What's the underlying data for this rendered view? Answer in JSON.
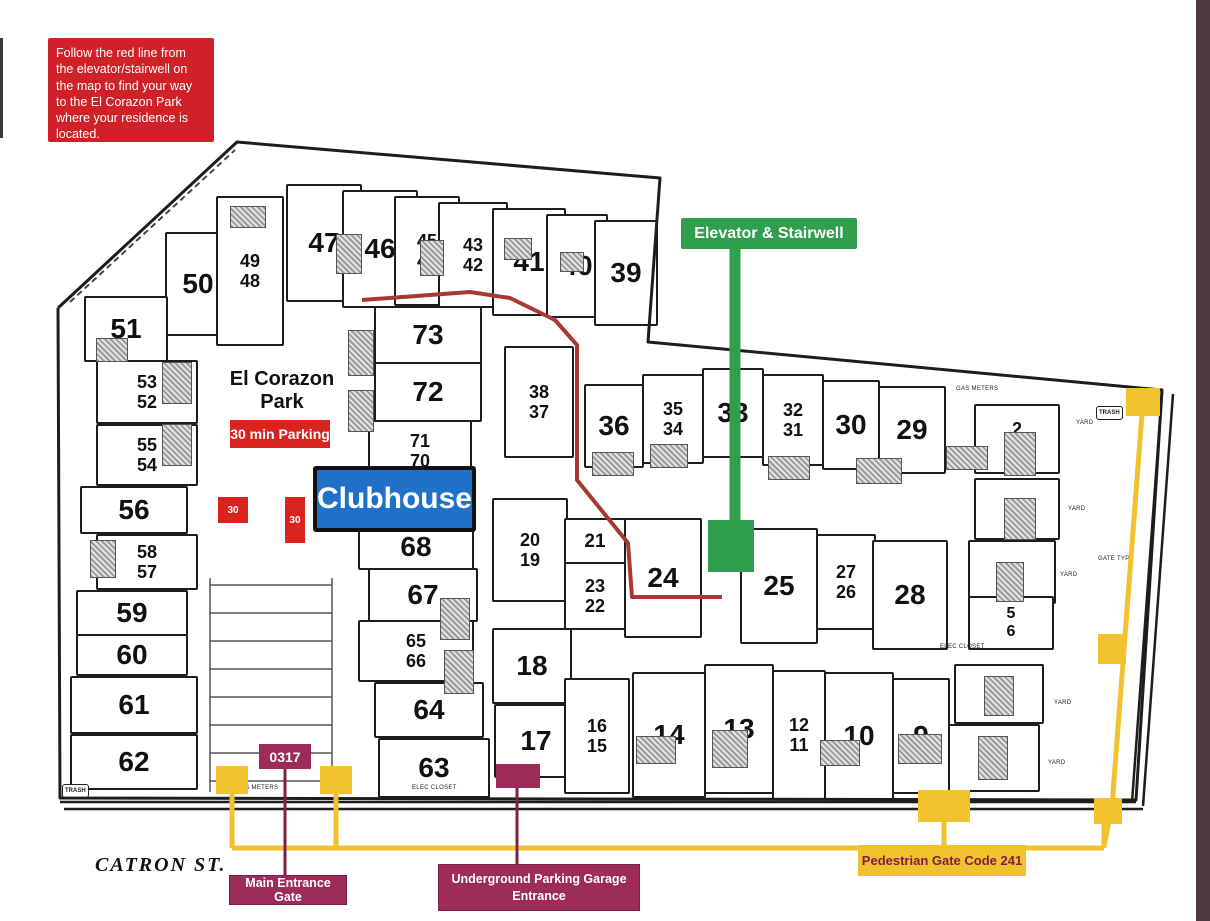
{
  "colors": {
    "red": "#cf2127",
    "maroon": "#9e2c58",
    "maroon_dark": "#7c2145",
    "yellow": "#f2c12e",
    "green": "#2f9e4d",
    "blue": "#1e71c6",
    "route_red": "#a83832",
    "ink": "#1d1d1d",
    "edge": "#4d3a41"
  },
  "annotations": {
    "instruction": "Follow the red line from the elevator/stairwell on the map to find your way to the El Corazon Park where your residence is located.",
    "elevator": "Elevator & Stairwell",
    "clubhouse": "Clubhouse",
    "park": "El Corazon\nPark",
    "parking": "30 min Parking",
    "stall": "30",
    "gate_code": "0317",
    "main_gate": "Main Entrance Gate",
    "garage": "Underground Parking Garage Entrance",
    "pedestrian": "Pedestrian Gate Code 241",
    "street": "CATRON ST."
  },
  "map": {
    "units": [
      {
        "label": "50",
        "x": 165,
        "y": 232,
        "w": 62,
        "h": 100,
        "fs": 28
      },
      {
        "label": "49\n48",
        "x": 216,
        "y": 196,
        "w": 64,
        "h": 146,
        "fs": 18
      },
      {
        "label": "47",
        "x": 286,
        "y": 184,
        "w": 72,
        "h": 114,
        "fs": 28
      },
      {
        "label": "46",
        "x": 342,
        "y": 190,
        "w": 72,
        "h": 114,
        "fs": 28
      },
      {
        "label": "45\n44",
        "x": 394,
        "y": 196,
        "w": 62,
        "h": 106,
        "fs": 18
      },
      {
        "label": "43\n42",
        "x": 438,
        "y": 202,
        "w": 66,
        "h": 102,
        "fs": 18
      },
      {
        "label": "41",
        "x": 492,
        "y": 208,
        "w": 70,
        "h": 104,
        "fs": 28
      },
      {
        "label": "40",
        "x": 546,
        "y": 214,
        "w": 58,
        "h": 100,
        "fs": 28
      },
      {
        "label": "39",
        "x": 594,
        "y": 220,
        "w": 60,
        "h": 102,
        "fs": 28
      },
      {
        "label": "51",
        "x": 84,
        "y": 296,
        "w": 80,
        "h": 62,
        "fs": 28
      },
      {
        "label": "53\n52",
        "x": 96,
        "y": 360,
        "w": 98,
        "h": 60,
        "fs": 18
      },
      {
        "label": "55\n54",
        "x": 96,
        "y": 424,
        "w": 98,
        "h": 58,
        "fs": 18
      },
      {
        "label": "56",
        "x": 80,
        "y": 486,
        "w": 104,
        "h": 44,
        "fs": 28
      },
      {
        "label": "58\n57",
        "x": 96,
        "y": 534,
        "w": 98,
        "h": 52,
        "fs": 18
      },
      {
        "label": "59",
        "x": 76,
        "y": 590,
        "w": 108,
        "h": 42,
        "fs": 28
      },
      {
        "label": "60",
        "x": 76,
        "y": 634,
        "w": 108,
        "h": 38,
        "fs": 28
      },
      {
        "label": "61",
        "x": 70,
        "y": 676,
        "w": 124,
        "h": 54,
        "fs": 28
      },
      {
        "label": "62",
        "x": 70,
        "y": 734,
        "w": 124,
        "h": 52,
        "fs": 28
      },
      {
        "label": "73",
        "x": 374,
        "y": 306,
        "w": 104,
        "h": 54,
        "fs": 28
      },
      {
        "label": "72",
        "x": 374,
        "y": 362,
        "w": 104,
        "h": 56,
        "fs": 28
      },
      {
        "label": "71\n70",
        "x": 368,
        "y": 420,
        "w": 100,
        "h": 58,
        "fs": 18
      },
      {
        "label": "68",
        "x": 358,
        "y": 524,
        "w": 112,
        "h": 42,
        "fs": 28
      },
      {
        "label": "67",
        "x": 368,
        "y": 568,
        "w": 106,
        "h": 50,
        "fs": 28
      },
      {
        "label": "65\n66",
        "x": 358,
        "y": 620,
        "w": 112,
        "h": 58,
        "fs": 18
      },
      {
        "label": "64",
        "x": 374,
        "y": 682,
        "w": 106,
        "h": 52,
        "fs": 28
      },
      {
        "label": "63",
        "x": 378,
        "y": 738,
        "w": 108,
        "h": 56,
        "fs": 28
      },
      {
        "label": "38\n37",
        "x": 504,
        "y": 346,
        "w": 66,
        "h": 108,
        "fs": 18
      },
      {
        "label": "20\n19",
        "x": 492,
        "y": 498,
        "w": 72,
        "h": 100,
        "fs": 18
      },
      {
        "label": "18",
        "x": 492,
        "y": 628,
        "w": 76,
        "h": 72,
        "fs": 28
      },
      {
        "label": "17",
        "x": 494,
        "y": 704,
        "w": 80,
        "h": 70,
        "fs": 28
      },
      {
        "label": "36",
        "x": 584,
        "y": 384,
        "w": 56,
        "h": 80,
        "fs": 28
      },
      {
        "label": "35\n34",
        "x": 642,
        "y": 374,
        "w": 58,
        "h": 86,
        "fs": 18
      },
      {
        "label": "33",
        "x": 702,
        "y": 368,
        "w": 58,
        "h": 86,
        "fs": 28
      },
      {
        "label": "32\n31",
        "x": 762,
        "y": 374,
        "w": 58,
        "h": 88,
        "fs": 18
      },
      {
        "label": "30",
        "x": 822,
        "y": 380,
        "w": 54,
        "h": 86,
        "fs": 28
      },
      {
        "label": "29",
        "x": 878,
        "y": 386,
        "w": 64,
        "h": 84,
        "fs": 28
      },
      {
        "label": "21",
        "x": 564,
        "y": 518,
        "w": 58,
        "h": 44,
        "fs": 19
      },
      {
        "label": "23\n22",
        "x": 564,
        "y": 562,
        "w": 58,
        "h": 64,
        "fs": 18
      },
      {
        "label": "24",
        "x": 624,
        "y": 518,
        "w": 74,
        "h": 116,
        "fs": 28
      },
      {
        "label": "25",
        "x": 740,
        "y": 528,
        "w": 74,
        "h": 112,
        "fs": 28
      },
      {
        "label": "27\n26",
        "x": 816,
        "y": 534,
        "w": 56,
        "h": 92,
        "fs": 18
      },
      {
        "label": "28",
        "x": 872,
        "y": 540,
        "w": 72,
        "h": 106,
        "fs": 28
      },
      {
        "label": "16\n15",
        "x": 564,
        "y": 678,
        "w": 62,
        "h": 112,
        "fs": 18
      },
      {
        "label": "14",
        "x": 632,
        "y": 672,
        "w": 70,
        "h": 122,
        "fs": 28
      },
      {
        "label": "13",
        "x": 704,
        "y": 664,
        "w": 66,
        "h": 126,
        "fs": 28
      },
      {
        "label": "12\n11",
        "x": 772,
        "y": 670,
        "w": 50,
        "h": 126,
        "fs": 18
      },
      {
        "label": "10",
        "x": 824,
        "y": 672,
        "w": 66,
        "h": 124,
        "fs": 28
      },
      {
        "label": "9",
        "x": 892,
        "y": 678,
        "w": 54,
        "h": 112,
        "fs": 28
      },
      {
        "label": "2\n1",
        "x": 974,
        "y": 404,
        "w": 82,
        "h": 66,
        "fs": 18
      },
      {
        "label": "3",
        "x": 974,
        "y": 478,
        "w": 82,
        "h": 58,
        "fs": 28
      },
      {
        "label": "4",
        "x": 968,
        "y": 540,
        "w": 84,
        "h": 60,
        "fs": 28
      },
      {
        "label": "5\n6",
        "x": 968,
        "y": 596,
        "w": 82,
        "h": 50,
        "fs": 16
      },
      {
        "label": "7",
        "x": 954,
        "y": 664,
        "w": 86,
        "h": 56,
        "fs": 28
      },
      {
        "label": "8",
        "x": 948,
        "y": 724,
        "w": 88,
        "h": 64,
        "fs": 28
      }
    ],
    "hatches": [
      {
        "x": 230,
        "y": 206,
        "w": 34,
        "h": 20
      },
      {
        "x": 336,
        "y": 234,
        "w": 24,
        "h": 38
      },
      {
        "x": 420,
        "y": 240,
        "w": 22,
        "h": 34
      },
      {
        "x": 504,
        "y": 238,
        "w": 26,
        "h": 20
      },
      {
        "x": 560,
        "y": 252,
        "w": 22,
        "h": 18
      },
      {
        "x": 96,
        "y": 338,
        "w": 30,
        "h": 22
      },
      {
        "x": 162,
        "y": 362,
        "w": 28,
        "h": 40
      },
      {
        "x": 162,
        "y": 424,
        "w": 28,
        "h": 40
      },
      {
        "x": 90,
        "y": 540,
        "w": 24,
        "h": 36
      },
      {
        "x": 348,
        "y": 330,
        "w": 24,
        "h": 44
      },
      {
        "x": 348,
        "y": 390,
        "w": 24,
        "h": 40
      },
      {
        "x": 440,
        "y": 598,
        "w": 28,
        "h": 40
      },
      {
        "x": 444,
        "y": 650,
        "w": 28,
        "h": 42
      },
      {
        "x": 592,
        "y": 452,
        "w": 40,
        "h": 22
      },
      {
        "x": 650,
        "y": 444,
        "w": 36,
        "h": 22
      },
      {
        "x": 768,
        "y": 456,
        "w": 40,
        "h": 22
      },
      {
        "x": 856,
        "y": 458,
        "w": 44,
        "h": 24
      },
      {
        "x": 946,
        "y": 446,
        "w": 40,
        "h": 22
      },
      {
        "x": 636,
        "y": 736,
        "w": 38,
        "h": 26
      },
      {
        "x": 712,
        "y": 730,
        "w": 34,
        "h": 36
      },
      {
        "x": 820,
        "y": 740,
        "w": 38,
        "h": 24
      },
      {
        "x": 898,
        "y": 734,
        "w": 42,
        "h": 28
      },
      {
        "x": 1004,
        "y": 432,
        "w": 30,
        "h": 42
      },
      {
        "x": 1004,
        "y": 498,
        "w": 30,
        "h": 40
      },
      {
        "x": 996,
        "y": 562,
        "w": 26,
        "h": 38
      },
      {
        "x": 984,
        "y": 676,
        "w": 28,
        "h": 38
      },
      {
        "x": 978,
        "y": 736,
        "w": 28,
        "h": 42
      }
    ],
    "small_labels": [
      {
        "text": "GAS METERS",
        "x": 236,
        "y": 785
      },
      {
        "text": "ELEC CLOSET",
        "x": 412,
        "y": 785
      },
      {
        "text": "GAS METERS",
        "x": 956,
        "y": 386
      },
      {
        "text": "ELEC CLOSET",
        "x": 940,
        "y": 644
      },
      {
        "text": "YARD",
        "x": 1076,
        "y": 420
      },
      {
        "text": "YARD",
        "x": 1068,
        "y": 506
      },
      {
        "text": "YARD",
        "x": 1060,
        "y": 572
      },
      {
        "text": "YARD",
        "x": 1054,
        "y": 700
      },
      {
        "text": "YARD",
        "x": 1048,
        "y": 760
      },
      {
        "text": "GATE TYP.",
        "x": 1098,
        "y": 556
      }
    ],
    "trash_boxes": [
      {
        "text": "TRASH",
        "x": 62,
        "y": 784
      },
      {
        "text": "TRASH",
        "x": 1096,
        "y": 406
      }
    ],
    "geometry": {
      "boundary": "58,308 237,142 660,178 648,342 1162,390 1136,800 60,798 58,308",
      "nw_dash": "70,302 235,150",
      "streets": [
        "60,802 1136,802",
        "64,809 1143,809",
        "1162,392 1132,802",
        "1173,394 1143,806"
      ],
      "parking_lines": [
        "210,578 210,792",
        "332,578 332,792",
        "210,585 332,585",
        "210,613 332,613",
        "210,641 332,641",
        "210,669 332,669",
        "210,697 332,697",
        "210,725 332,725",
        "210,753 332,753",
        "210,781 332,781"
      ],
      "red_route": "362,300 470,292 510,298 555,320 577,345 577,480 628,543 632,597 722,597",
      "green_line": "735,248 735,522",
      "yellow_routes": [
        "232,792 232,848",
        "336,792 336,848",
        "232,848 1104,848",
        "944,820 944,848",
        "1104,822 1104,848",
        "1142,414 1112,806 1104,846"
      ],
      "maroon_lines": [
        "285,768 285,877",
        "517,786 517,866"
      ],
      "gates": [
        {
          "x": 216,
          "y": 766,
          "w": 32,
          "h": 28
        },
        {
          "x": 320,
          "y": 766,
          "w": 32,
          "h": 28
        },
        {
          "x": 1126,
          "y": 388,
          "w": 34,
          "h": 28
        },
        {
          "x": 1098,
          "y": 634,
          "w": 28,
          "h": 30
        },
        {
          "x": 918,
          "y": 790,
          "w": 52,
          "h": 32
        },
        {
          "x": 1094,
          "y": 798,
          "w": 28,
          "h": 26
        }
      ],
      "green_square": {
        "x": 708,
        "y": 520,
        "w": 46,
        "h": 52
      },
      "garage_marker": {
        "x": 496,
        "y": 764,
        "w": 44,
        "h": 24
      }
    }
  }
}
